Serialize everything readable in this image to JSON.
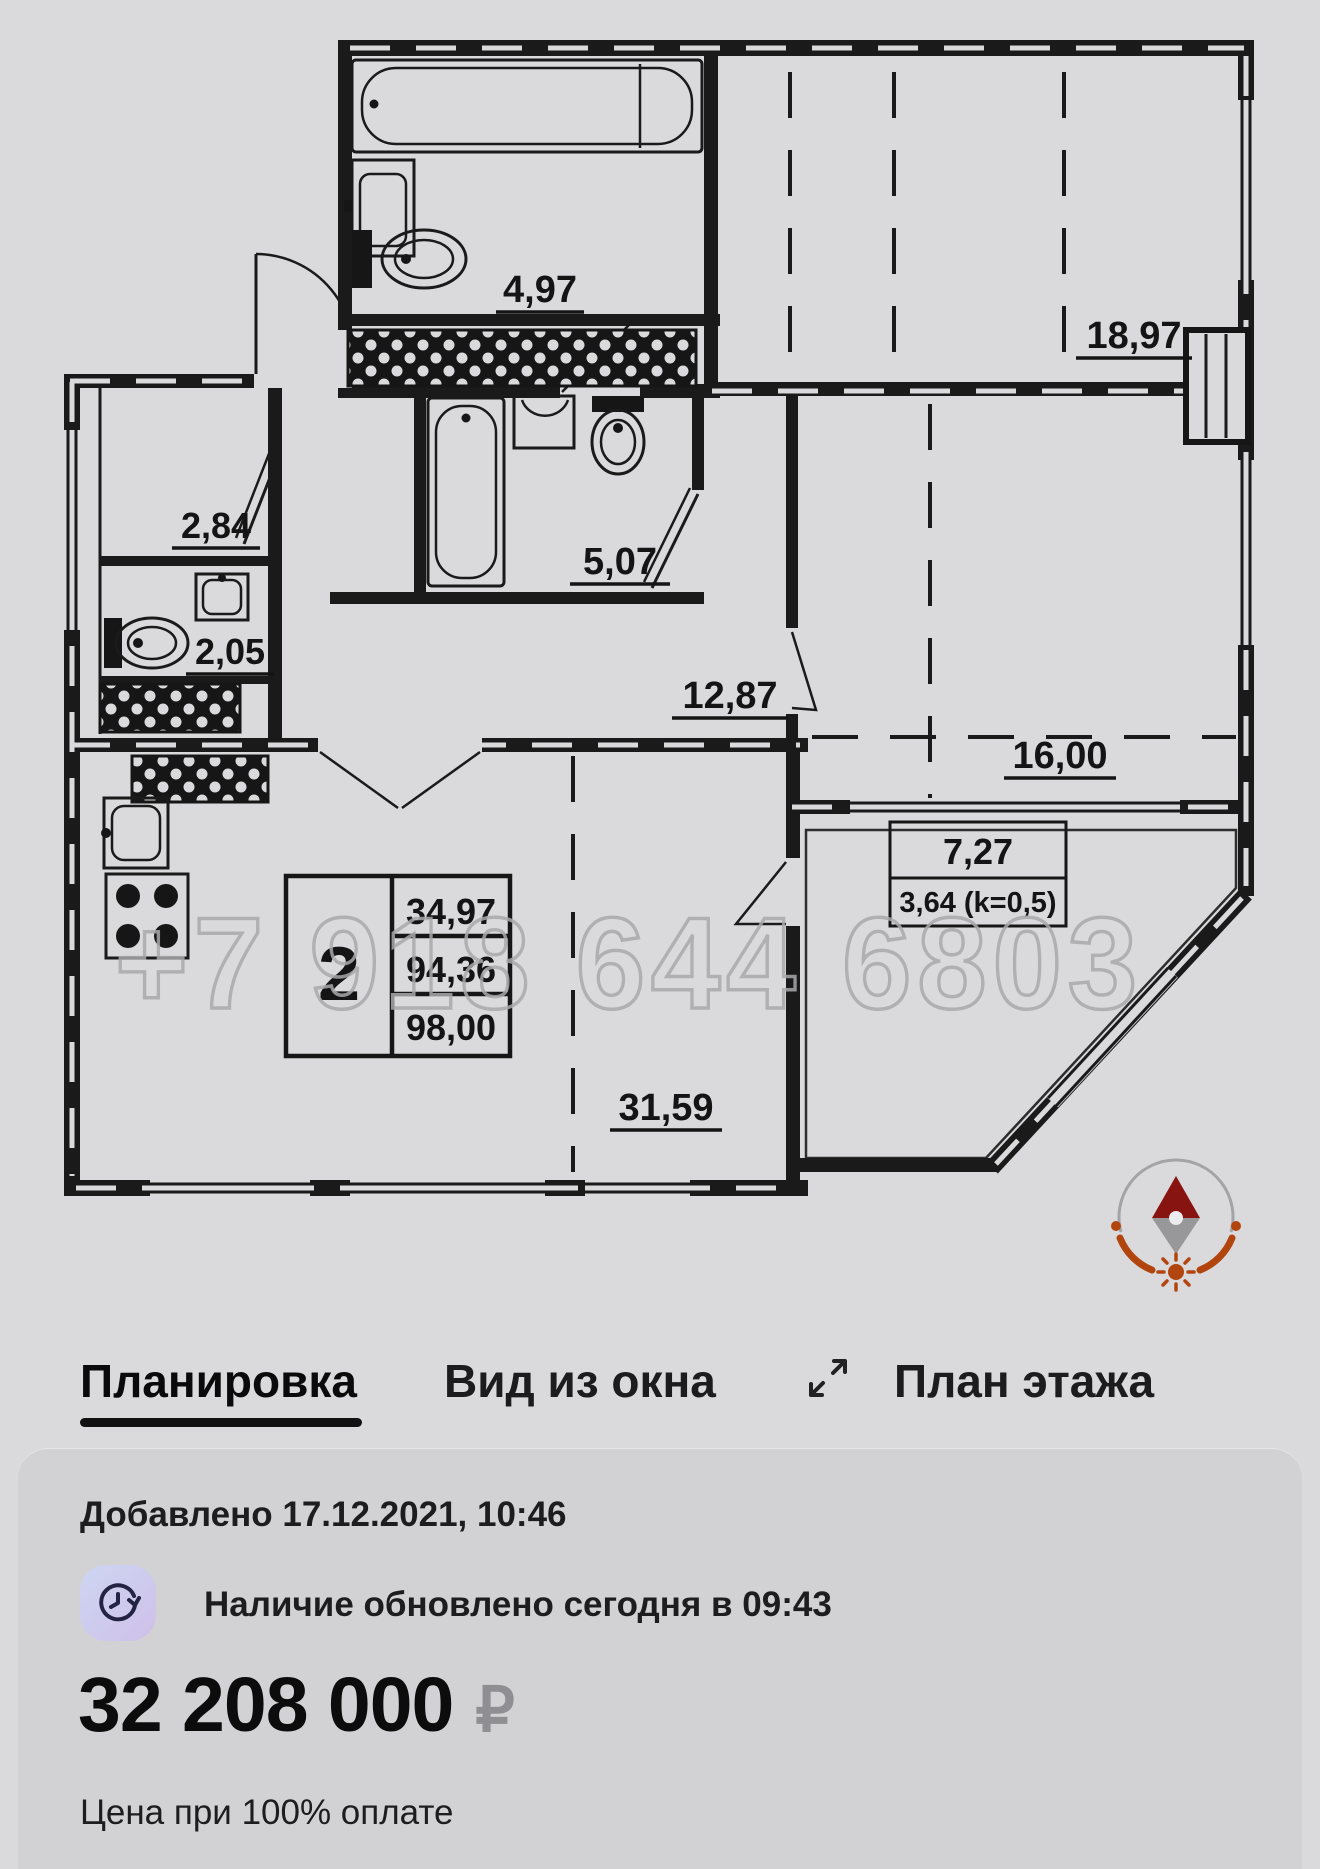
{
  "floorplan": {
    "watermark": "+7 918 644 6803",
    "areas": {
      "bath_top": "4,97",
      "room_top_right": "18,97",
      "hall_small": "2,84",
      "wc": "2,05",
      "bath_mid": "5,07",
      "hallway": "12,87",
      "room_right": "16,00",
      "terrace": "7,27",
      "terrace_coeff": "3,64 (k=0,5)",
      "living_kitchen": "31,59"
    },
    "table": {
      "rooms": "2",
      "row1": "34,97",
      "row2": "94,36",
      "row3": "98,00"
    }
  },
  "tabs": [
    {
      "label": "Планировка",
      "active": true
    },
    {
      "label": "Вид из окна",
      "active": false
    },
    {
      "label": "План этажа",
      "active": false
    }
  ],
  "listing": {
    "added": "Добавлено 17.12.2021, 10:46",
    "availability": "Наличие обновлено сегодня в 09:43",
    "price": "32 208 000",
    "currency": "₽",
    "note": "Цена при 100% оплате"
  },
  "colors": {
    "page_bg": "#dadadc",
    "card_bg": "#d2d2d4",
    "accent_rust": "#b2450e",
    "needle_maroon": "#871410",
    "badge_from": "#ced6f3",
    "badge_to": "#cfc0e9"
  }
}
